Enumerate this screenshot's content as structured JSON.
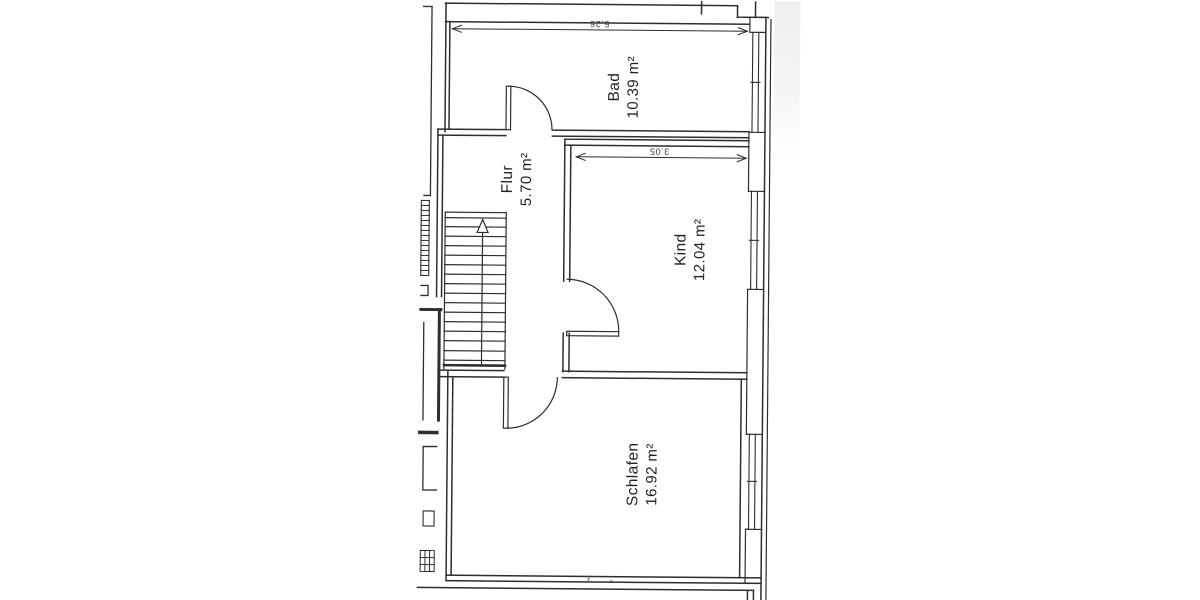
{
  "floorplan": {
    "rooms": [
      {
        "id": "bad",
        "name": "Bad",
        "area": "10.39 m²"
      },
      {
        "id": "flur",
        "name": "Flur",
        "area": "5.70 m²"
      },
      {
        "id": "kind",
        "name": "Kind",
        "area": "12.04 m²"
      },
      {
        "id": "schlafen",
        "name": "Schlafen",
        "area": "16.92 m²"
      }
    ],
    "dimensions": [
      {
        "id": "bad-width",
        "label": "5.26"
      },
      {
        "id": "kind-width",
        "label": "3.05"
      }
    ],
    "colors": {
      "line": "#2e2e2e",
      "text": "#1f1f1f",
      "paper": "#ffffff"
    }
  }
}
